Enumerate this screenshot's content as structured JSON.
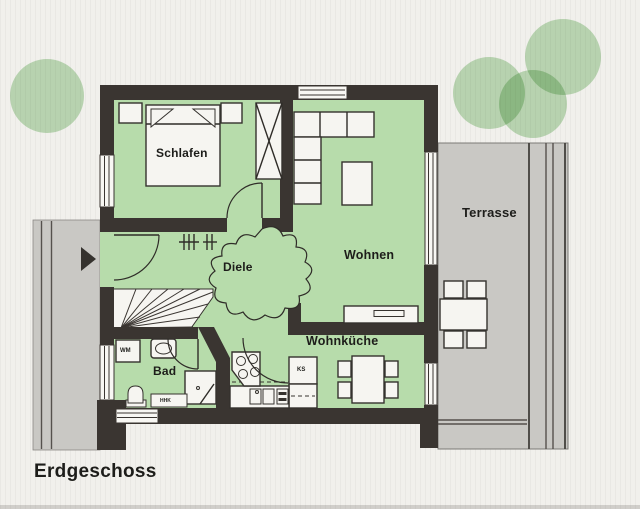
{
  "plan": {
    "title": "Erdgeschoss",
    "rooms": {
      "schlafen": "Schlafen",
      "diele": "Diele",
      "wohnen": "Wohnen",
      "wohnkueche": "Wohnküche",
      "bad": "Bad",
      "terrasse": "Terrasse"
    },
    "labels": {
      "wm": "WM",
      "ks": "KS",
      "hhk": "HHK"
    },
    "colors": {
      "room_green": "#b7dcab",
      "terrace_gray": "#c9c8c4",
      "wall": "#3a3531",
      "tree_green": "#8fc487",
      "paper": "#f1f0ec"
    }
  }
}
